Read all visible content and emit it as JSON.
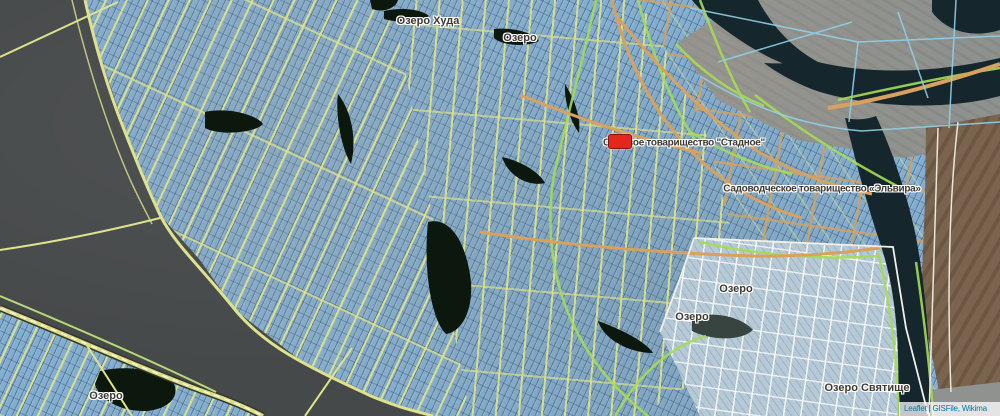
{
  "map": {
    "type": "leaflet-cadastral-satellite-view",
    "labels": [
      {
        "id": "lake-khuda",
        "text": "Озеро Худа"
      },
      {
        "id": "lake-top",
        "text": "Озеро"
      },
      {
        "id": "stadnoe",
        "text": "Садовое товарищество \"Стадное\""
      },
      {
        "id": "elvira",
        "text": "Садоводческое товарищество «Эльвира»"
      },
      {
        "id": "lake-mid-upper",
        "text": "Озеро"
      },
      {
        "id": "lake-mid-lower",
        "text": "Озеро"
      },
      {
        "id": "lake-svyatishche",
        "text": "Озеро Святище"
      },
      {
        "id": "lake-southwest",
        "text": "Озеро"
      }
    ],
    "marker": {
      "shape": "red-rounded-rectangle",
      "color": "#e3271d"
    },
    "attribution": {
      "leaflet_label": "Leaflet",
      "separator": "|",
      "sources_label": "GISFile, Wikima"
    },
    "colors": {
      "river_water": "#46494a",
      "dark_water": "#15272c",
      "parcel_fill": "#84aecf",
      "street_yellow": "#dfe28a",
      "road_orange": "#d8a15d",
      "track_green": "#a6dc55",
      "terrain_gray": "#8e918e",
      "terrain_brown": "#7a644e",
      "pale_parcels": "#b6c9d6",
      "label_text": "#3e3a33",
      "link_blue": "#0078A8"
    }
  }
}
